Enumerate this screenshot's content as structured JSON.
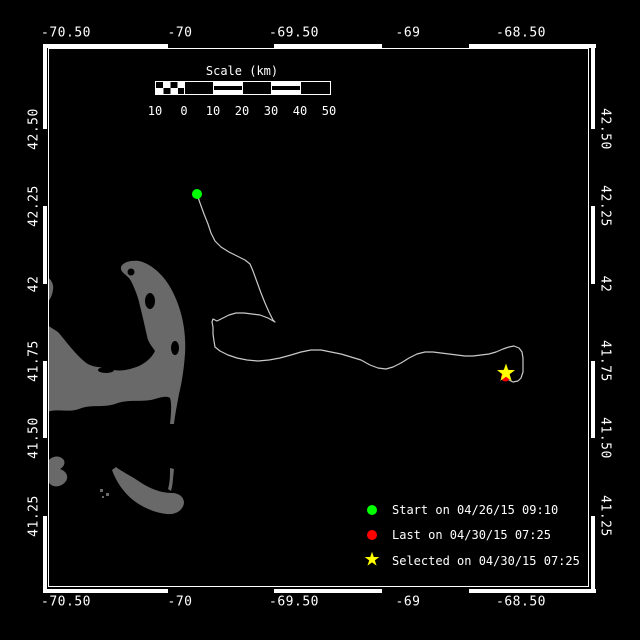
{
  "axes": {
    "top": [
      "-70.50",
      "-70",
      "-69.50",
      "-69",
      "-68.50"
    ],
    "bottom": [
      "-70.50",
      "-70",
      "-69.50",
      "-69",
      "-68.50"
    ],
    "left": [
      "42.50",
      "42.25",
      "42",
      "41.75",
      "41.50",
      "41.25"
    ],
    "right": [
      "42.50",
      "42.25",
      "42",
      "41.75",
      "41.50",
      "41.25"
    ]
  },
  "scale_bar": {
    "title": "Scale (km)",
    "labels": [
      "10",
      "0",
      "10",
      "20",
      "30",
      "40",
      "50"
    ]
  },
  "legend": {
    "star_glyph": "★",
    "items": [
      {
        "shape": "circle",
        "color": "#00ff00",
        "label": "Start on 04/26/15 09:10"
      },
      {
        "shape": "circle",
        "color": "#ff0000",
        "label": "Last on 04/30/15 07:25"
      },
      {
        "shape": "star",
        "color": "#ffff00",
        "label": "Selected on 04/30/15 07:25"
      }
    ]
  },
  "colors": {
    "background": "#000000",
    "frame": "#ffffff",
    "land": "#696969",
    "track": "#c9c9c9",
    "start": "#00ff00",
    "last": "#ff0000",
    "selected": "#ffff00"
  },
  "markers": {
    "start": {
      "x": 197,
      "y": 194,
      "color": "#00ff00",
      "shape": "circle"
    },
    "last": {
      "x": 505.5,
      "y": 377,
      "color": "#ff0000",
      "shape": "circle"
    },
    "selected": {
      "x": 506,
      "y": 373,
      "color": "#ffff00",
      "shape": "star"
    }
  },
  "track": {
    "color": "#c9c9c9",
    "points": [
      [
        197,
        194
      ],
      [
        200,
        203
      ],
      [
        204,
        214
      ],
      [
        208,
        224
      ],
      [
        211,
        233
      ],
      [
        215,
        241
      ],
      [
        221,
        247
      ],
      [
        229,
        252
      ],
      [
        237,
        256
      ],
      [
        245,
        260
      ],
      [
        250,
        264
      ],
      [
        253,
        271
      ],
      [
        257,
        282
      ],
      [
        261,
        293
      ],
      [
        265,
        303
      ],
      [
        269,
        312
      ],
      [
        273,
        320
      ],
      [
        275,
        322
      ],
      [
        268,
        318
      ],
      [
        260,
        315
      ],
      [
        252,
        314
      ],
      [
        244,
        313
      ],
      [
        236,
        313
      ],
      [
        229,
        315
      ],
      [
        223,
        318
      ],
      [
        217,
        321
      ],
      [
        213,
        319
      ],
      [
        212,
        322
      ],
      [
        213,
        327
      ],
      [
        213,
        334
      ],
      [
        214,
        341
      ],
      [
        215,
        347
      ],
      [
        220,
        351
      ],
      [
        228,
        355
      ],
      [
        237,
        358
      ],
      [
        247,
        360
      ],
      [
        258,
        361
      ],
      [
        269,
        360
      ],
      [
        280,
        358
      ],
      [
        291,
        355
      ],
      [
        301,
        352
      ],
      [
        311,
        350
      ],
      [
        321,
        350
      ],
      [
        331,
        352
      ],
      [
        341,
        354
      ],
      [
        351,
        357
      ],
      [
        361,
        360
      ],
      [
        370,
        365
      ],
      [
        378,
        368
      ],
      [
        386,
        369
      ],
      [
        393,
        367
      ],
      [
        401,
        363
      ],
      [
        409,
        358
      ],
      [
        417,
        354
      ],
      [
        425,
        352
      ],
      [
        433,
        352
      ],
      [
        441,
        353
      ],
      [
        449,
        354
      ],
      [
        457,
        355
      ],
      [
        465,
        356
      ],
      [
        473,
        356
      ],
      [
        481,
        355
      ],
      [
        489,
        354
      ],
      [
        496,
        352
      ],
      [
        503,
        349
      ],
      [
        509,
        347
      ],
      [
        514,
        346
      ],
      [
        519,
        348
      ],
      [
        522,
        352
      ],
      [
        523,
        358
      ],
      [
        523,
        366
      ],
      [
        523,
        372
      ],
      [
        521,
        378
      ],
      [
        518,
        381
      ],
      [
        513,
        382
      ],
      [
        509,
        380
      ],
      [
        505,
        377
      ]
    ]
  }
}
